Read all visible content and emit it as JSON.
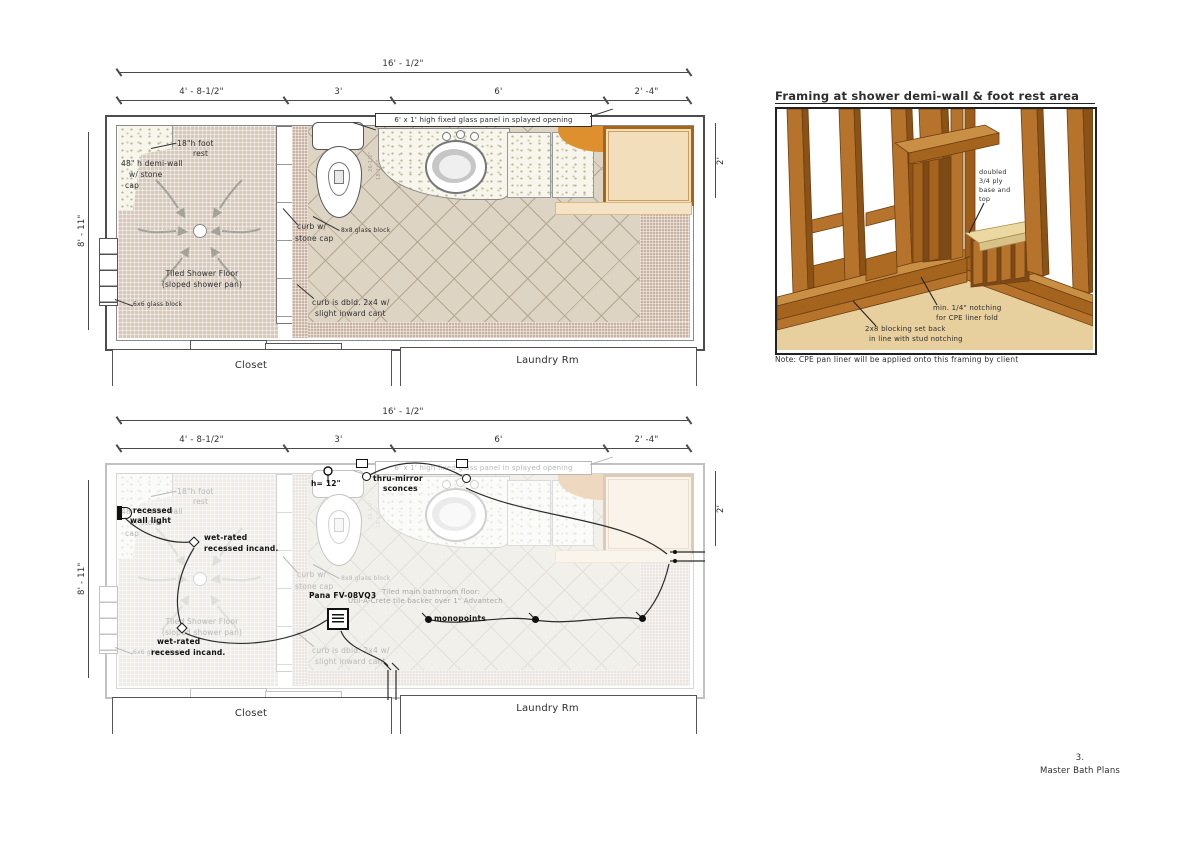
{
  "page": {
    "number": "3.",
    "title": "Master Bath Plans"
  },
  "dims": {
    "total": "16' - 1/2\"",
    "seg1": "4' - 8-1/2\"",
    "seg2": "3'",
    "seg3": "6'",
    "seg4": "2' -4\"",
    "left": "8' - 11\"",
    "right": "2'"
  },
  "rooms": {
    "closet": "Closet",
    "laundry": "Laundry Rm"
  },
  "annot": {
    "foot_rest_1": "18\"h foot",
    "foot_rest_2": "rest",
    "demi_1": "48\" h demi-wall",
    "demi_2": "w/ stone",
    "demi_3": "cap",
    "shower_1": "Tiled Shower Floor",
    "shower_2": "(sloped shower pan)",
    "glass6": "6x6 glass block",
    "glass8": "8x8 glass block",
    "curb_1": "curb w/",
    "curb_2": "stone cap",
    "cant_1": "curb is dbld. 2x4 w/",
    "cant_2": "slight inward cant",
    "glass_panel": "6' x 1' high fixed glass panel in splayed opening",
    "dim_a": "26-1/2\"",
    "dim_b": "18-1/2\""
  },
  "elec": {
    "sconce_1": "thru-mirror",
    "sconce_2": "sconces",
    "height": "h= 12\"",
    "wall_light_1": "recessed",
    "wall_light_2": "wall light",
    "wet_1": "wet-rated",
    "wet_2": "recessed incand.",
    "fan": "Pana FV-08VQ3",
    "monopoints": "monopoints",
    "floor_1": "Tiled main bathroom floor:",
    "floor_2": "Util-A-Crete tile backer over 1\" Advantech"
  },
  "framing": {
    "title": "Framing at shower demi-wall & foot rest area",
    "ply_1": "doubled",
    "ply_2": "3/4 ply",
    "ply_3": "base and",
    "ply_4": "top",
    "notch_1": "min. 1/4\" notching",
    "notch_2": "for CPE liner fold",
    "block_1": "2x8 blocking set back",
    "block_2": "in line with stud notching",
    "note": "Note: CPE pan liner will be applied onto this framing by client"
  },
  "colors": {
    "wood": "#b5732c",
    "wood_dark": "#8a5216",
    "wood_light": "#c98f44",
    "ply": "#ecd8a2",
    "cabinet": "#f3debb",
    "cabinet_border": "#a5661c",
    "accent_orange": "#df902e",
    "shower_mosaic": "#d7c8ba",
    "tile_floor": "#ded4c3",
    "line": "#3a3a3a"
  }
}
